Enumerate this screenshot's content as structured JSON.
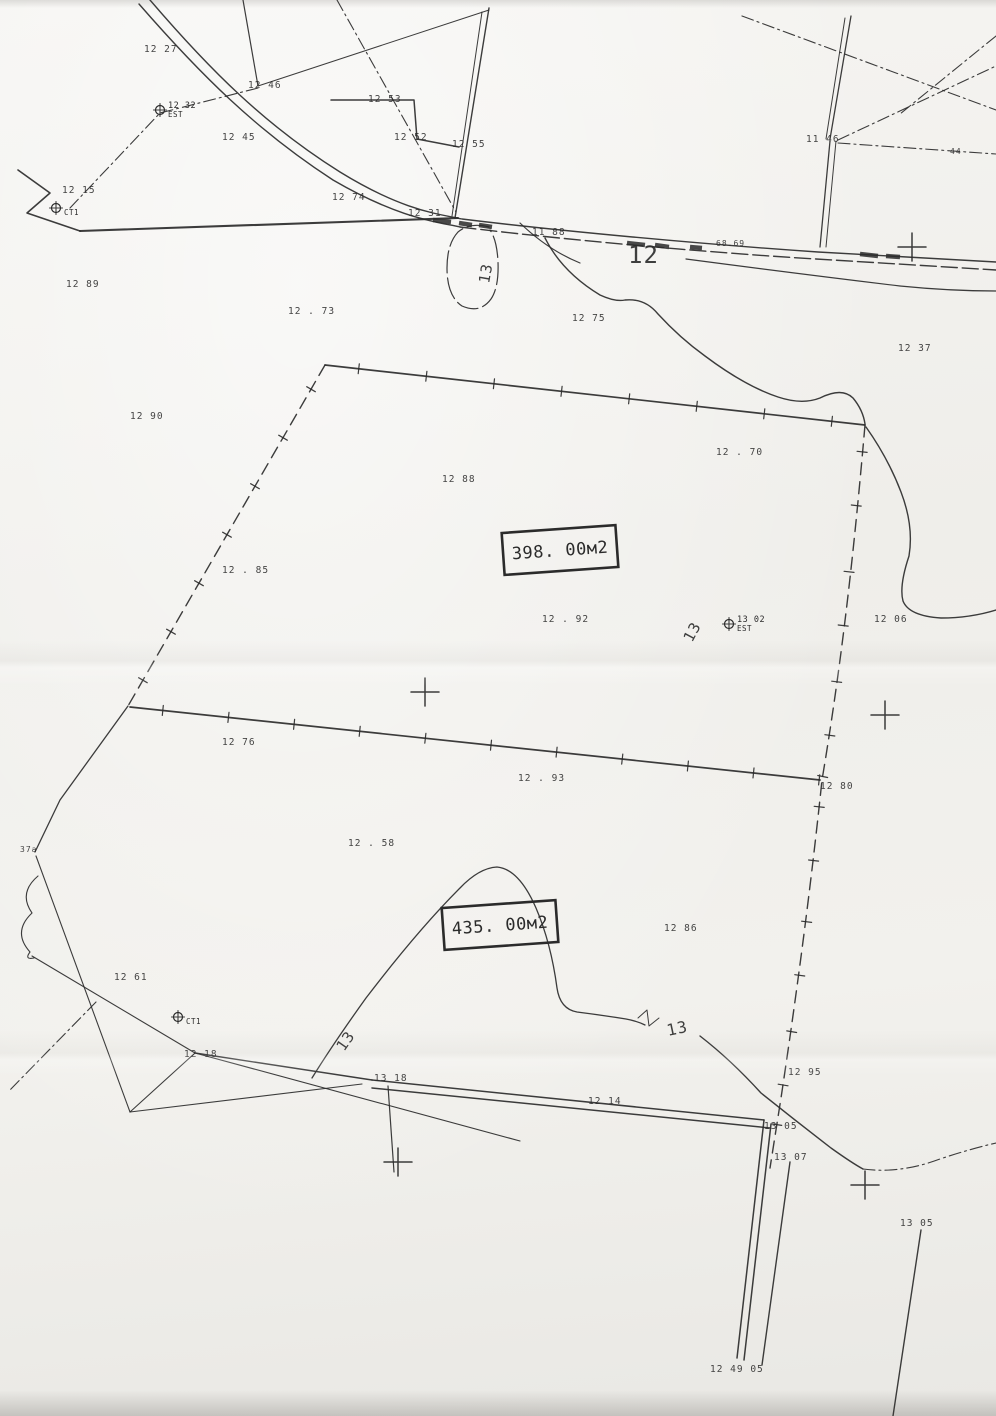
{
  "colors": {
    "ink": "#2b2b2b",
    "paper": "#f3f2ef"
  },
  "map": {
    "parcels": [
      {
        "area_label": "398. 00м2",
        "x": 560,
        "y": 550,
        "rotate": -4
      },
      {
        "area_label": "435. 00м2",
        "x": 500,
        "y": 925,
        "rotate": -4
      }
    ],
    "contour_labels": [
      {
        "text": "12",
        "x": 628,
        "y": 263,
        "size": 24,
        "rotate": 0
      },
      {
        "text": "13",
        "x": 489,
        "y": 284,
        "size": 15,
        "rotate": -80
      },
      {
        "text": "13",
        "x": 692,
        "y": 643,
        "size": 15,
        "rotate": -62
      },
      {
        "text": "13",
        "x": 344,
        "y": 1052,
        "size": 15,
        "rotate": -55
      },
      {
        "text": "13",
        "x": 668,
        "y": 1036,
        "size": 16,
        "rotate": -12
      }
    ],
    "spot_elevations": [
      {
        "text": "12  27",
        "x": 144,
        "y": 52
      },
      {
        "text": "12  46",
        "x": 248,
        "y": 88
      },
      {
        "text": "12  53",
        "x": 368,
        "y": 102
      },
      {
        "text": "12  45",
        "x": 222,
        "y": 140
      },
      {
        "text": "12  52",
        "x": 394,
        "y": 140
      },
      {
        "text": "12  55",
        "x": 452,
        "y": 147
      },
      {
        "text": "11  46",
        "x": 806,
        "y": 142
      },
      {
        "text": "44",
        "x": 950,
        "y": 154,
        "size": 8
      },
      {
        "text": "12  15",
        "x": 62,
        "y": 193
      },
      {
        "text": "12  74",
        "x": 332,
        "y": 200
      },
      {
        "text": "12  31",
        "x": 408,
        "y": 216
      },
      {
        "text": "11  88",
        "x": 532,
        "y": 235
      },
      {
        "text": "68.69",
        "x": 716,
        "y": 246,
        "size": 8
      },
      {
        "text": "12  89",
        "x": 66,
        "y": 287
      },
      {
        "text": "12 . 73",
        "x": 288,
        "y": 314
      },
      {
        "text": "12  75",
        "x": 572,
        "y": 321
      },
      {
        "text": "12  37",
        "x": 898,
        "y": 351
      },
      {
        "text": "12  90",
        "x": 130,
        "y": 419
      },
      {
        "text": "12 . 70",
        "x": 716,
        "y": 455
      },
      {
        "text": "12  88",
        "x": 442,
        "y": 482
      },
      {
        "text": "12 . 85",
        "x": 222,
        "y": 573
      },
      {
        "text": "12 . 92",
        "x": 542,
        "y": 622
      },
      {
        "text": "12  06",
        "x": 874,
        "y": 622
      },
      {
        "text": "12  76",
        "x": 222,
        "y": 745
      },
      {
        "text": "12 . 93",
        "x": 518,
        "y": 781
      },
      {
        "text": "12  80",
        "x": 820,
        "y": 789
      },
      {
        "text": "12 . 58",
        "x": 348,
        "y": 846
      },
      {
        "text": "37a",
        "x": 20,
        "y": 852,
        "size": 8
      },
      {
        "text": "12  86",
        "x": 664,
        "y": 931
      },
      {
        "text": "12  61",
        "x": 114,
        "y": 980
      },
      {
        "text": "12  18",
        "x": 184,
        "y": 1057
      },
      {
        "text": "13  18",
        "x": 374,
        "y": 1081
      },
      {
        "text": "12  14",
        "x": 588,
        "y": 1104
      },
      {
        "text": "12  95",
        "x": 788,
        "y": 1075
      },
      {
        "text": "13  05",
        "x": 764,
        "y": 1129
      },
      {
        "text": "13  07",
        "x": 774,
        "y": 1160
      },
      {
        "text": "13  05",
        "x": 900,
        "y": 1226
      },
      {
        "text": "12  49  05",
        "x": 710,
        "y": 1372
      }
    ],
    "stations": [
      {
        "x": 160,
        "y": 110,
        "value": "12  32",
        "label": "EST"
      },
      {
        "x": 56,
        "y": 208,
        "value": "",
        "label": "CT1"
      },
      {
        "x": 729,
        "y": 624,
        "value": "13  02",
        "label": "EST"
      },
      {
        "x": 178,
        "y": 1017,
        "value": "",
        "label": "CT1"
      }
    ],
    "crosses": [
      {
        "x": 912,
        "y": 247
      },
      {
        "x": 425,
        "y": 692
      },
      {
        "x": 885,
        "y": 715
      },
      {
        "x": 398,
        "y": 1162
      },
      {
        "x": 865,
        "y": 1185
      }
    ]
  }
}
